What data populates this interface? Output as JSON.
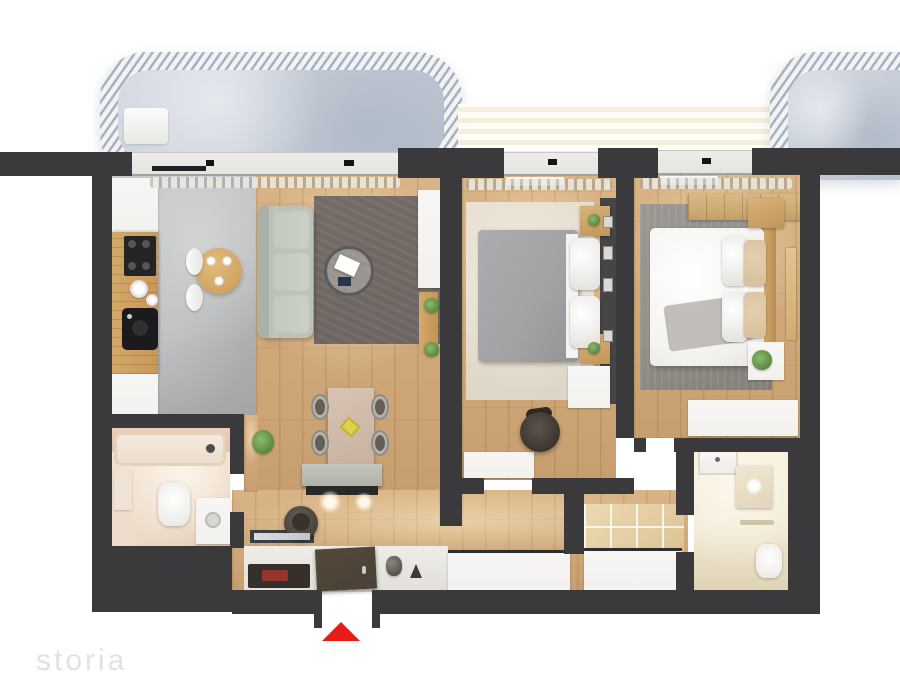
{
  "watermark": {
    "text": "storia"
  },
  "entrance": {
    "marker_icon": "triangle-up-icon",
    "marker_color": "#e81c16"
  },
  "palette": {
    "wall": "#3a3a3c",
    "wood": "#d9b486",
    "kitchen-floor": "#b3b5b6",
    "balcony-floor": "#c6cdd8",
    "stripe-band": "#f5eedd",
    "rug-living": "#6c6460",
    "rug-bed1": "#e8e1d4",
    "rug-bed2": "#94908a",
    "sofa": "#bcc2b8",
    "counter": "#c89758",
    "white-furniture": "#f2f1ee",
    "bath1-floor": "#eddbc8",
    "bath2-floor": "#f1e8d4",
    "duvet-bed1": "#a0a2a4",
    "duvet-bed2": "#f4f2ee",
    "pillow-tan": "#d9c19e",
    "door": "#4a4136",
    "marker": "#e81c16"
  }
}
